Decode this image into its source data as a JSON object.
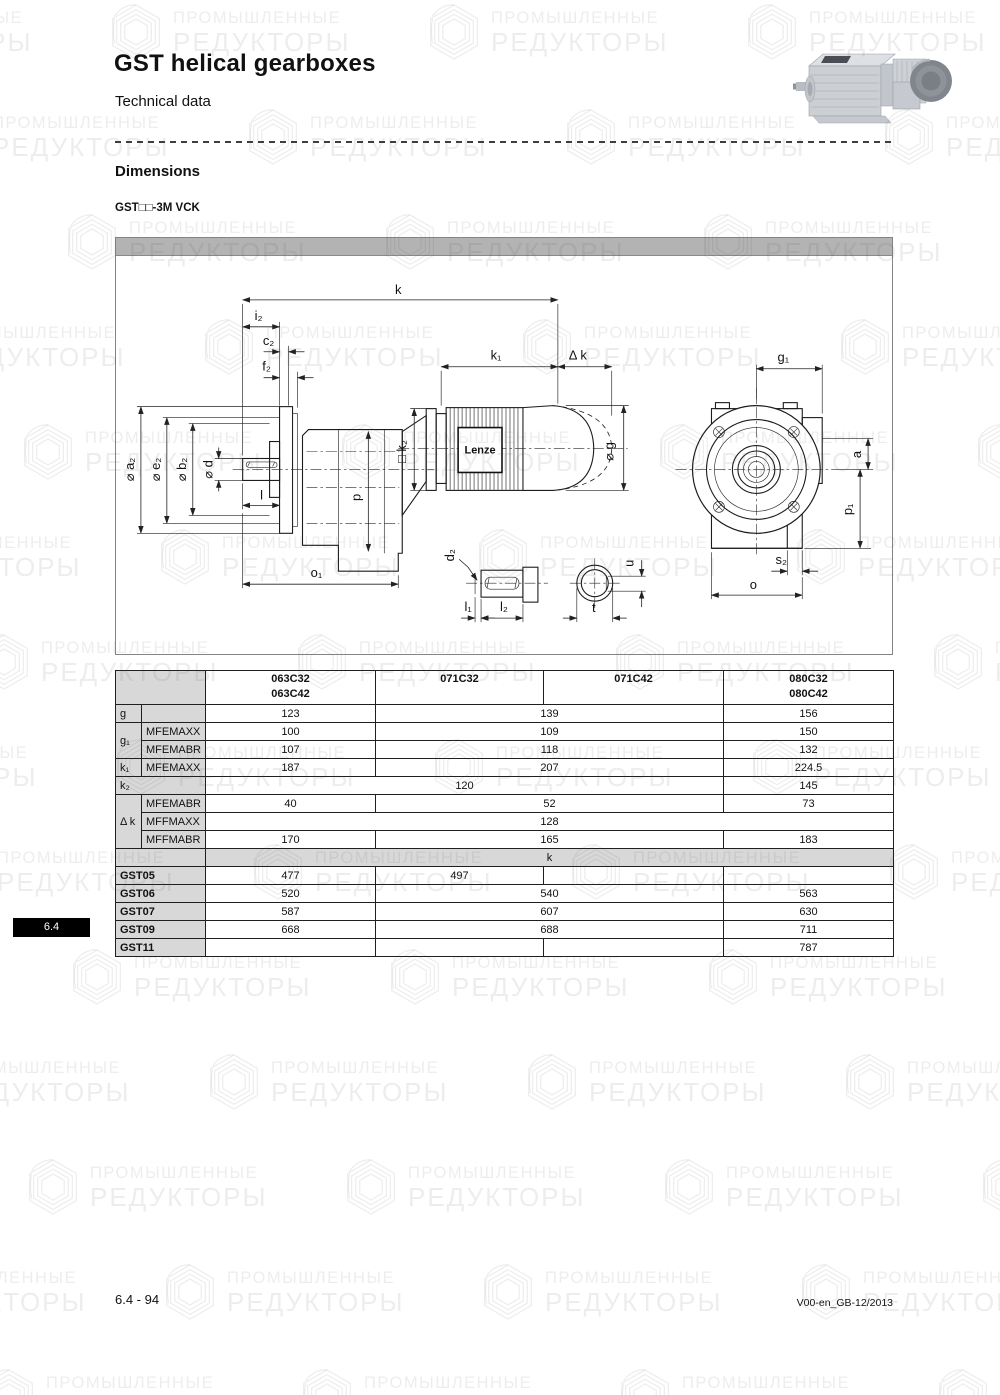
{
  "page": {
    "title": "GST helical gearboxes",
    "subtitle": "Technical data",
    "section_heading": "Dimensions",
    "variant_label": "GST□□-3M VCK",
    "tab_label": "6.4",
    "footer_left": "6.4 - 94",
    "footer_right": "V00-en_GB-12/2013"
  },
  "watermark": {
    "line1": "ПРОМЫШЛЕННЫЕ",
    "line2": "РЕДУКТОРЫ"
  },
  "drawing": {
    "brand": "Lenze",
    "labels": {
      "k": "k",
      "i2": "i₂",
      "c2": "c₂",
      "f2": "f₂",
      "k1": "k₁",
      "dk": "Δ k",
      "g1": "g₁",
      "a2": "⌀ a₂",
      "e2": "⌀ e₂",
      "b2": "⌀ b₂",
      "d": "⌀ d",
      "l": "l",
      "p": "p",
      "k2": "□ k₂",
      "g": "⌀ g",
      "o1": "o₁",
      "d2": "d₂",
      "l1": "l₁",
      "l2": "l₂",
      "t": "t",
      "u": "u",
      "s2": "s₂",
      "o": "o",
      "a": "a",
      "p1": "p₁"
    }
  },
  "table": {
    "headers": {
      "h063a": "063C32",
      "h063b": "063C42",
      "h071c32": "071C32",
      "h071c42": "071C42",
      "h080a": "080C32",
      "h080b": "080C42"
    },
    "rows": {
      "g": {
        "label": "g",
        "sub": "",
        "v063": "123",
        "v071": "139",
        "v080": "156"
      },
      "g1max": {
        "label": "g₁",
        "sub": "MFEMAXX",
        "v063": "100",
        "v071": "109",
        "v080": "150"
      },
      "g1abr": {
        "sub": "MFEMABR",
        "v063": "107",
        "v071": "118",
        "v080": "132"
      },
      "k1": {
        "label": "k₁",
        "sub": "MFEMAXX",
        "v063": "187",
        "v071": "207",
        "v080": "224.5"
      },
      "k2": {
        "label": "k₂",
        "v063_071": "120",
        "v080": "145"
      },
      "dk_abr": {
        "label": "Δ k",
        "sub": "MFEMABR",
        "v063": "40",
        "v071": "52",
        "v080": "73"
      },
      "dk_fmax": {
        "sub": "MFFMAXX",
        "vall": "128"
      },
      "dk_fabr": {
        "sub": "MFFMABR",
        "v063": "170",
        "v071": "165",
        "v080": "183"
      },
      "kband": {
        "label": "k"
      },
      "gst05": {
        "label": "GST05",
        "v063": "477",
        "v071c32": "497",
        "v071c42": "",
        "v080": ""
      },
      "gst06": {
        "label": "GST06",
        "v063": "520",
        "v071": "540",
        "v080": "563"
      },
      "gst07": {
        "label": "GST07",
        "v063": "587",
        "v071": "607",
        "v080": "630"
      },
      "gst09": {
        "label": "GST09",
        "v063": "668",
        "v071": "688",
        "v080": "711"
      },
      "gst11": {
        "label": "GST11",
        "v063": "",
        "v071c32": "",
        "v071c42": "",
        "v080": "787"
      }
    }
  }
}
